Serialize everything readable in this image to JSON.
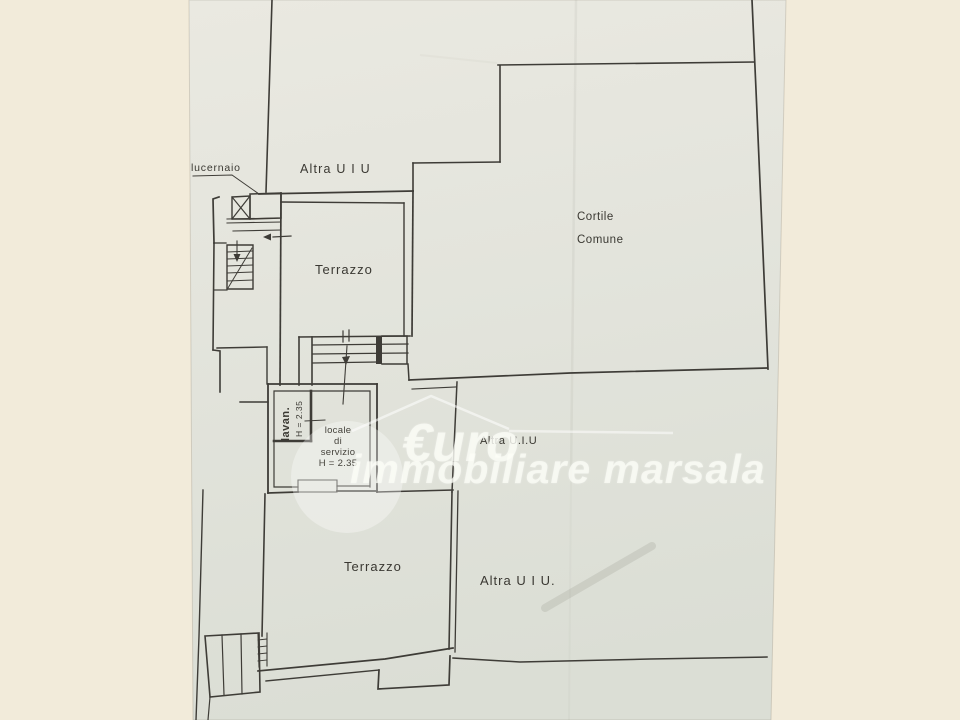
{
  "document_kind": "scanned floor plan (planimetria catastale)",
  "colors": {
    "scan_background": "#f2ebda",
    "paper_top": "#eae9e1",
    "paper_bottom": "#dbded5",
    "ink": "#3e3c37",
    "watermark": "#fcfdf7"
  },
  "labels": {
    "lucernaio": "lucernaio",
    "altra_uiu_top": "Altra U I U",
    "cortile_line1": "Cortile",
    "cortile_line2": "Comune",
    "terrazzo_upper": "Terrazzo",
    "lavan": "lavan.",
    "lavan_height": "H = 2.35",
    "locale_line1": "locale",
    "locale_line2": "di",
    "locale_line3": "servizio",
    "locale_height": "H = 2.35",
    "altra_uiu_mid": "Altra U.I.U",
    "terrazzo_lower": "Terrazzo",
    "altra_uiu_bottom": "Altra U I U."
  },
  "watermark": {
    "word_euro": "€uro",
    "word_rest": "immobiliare marsala"
  }
}
